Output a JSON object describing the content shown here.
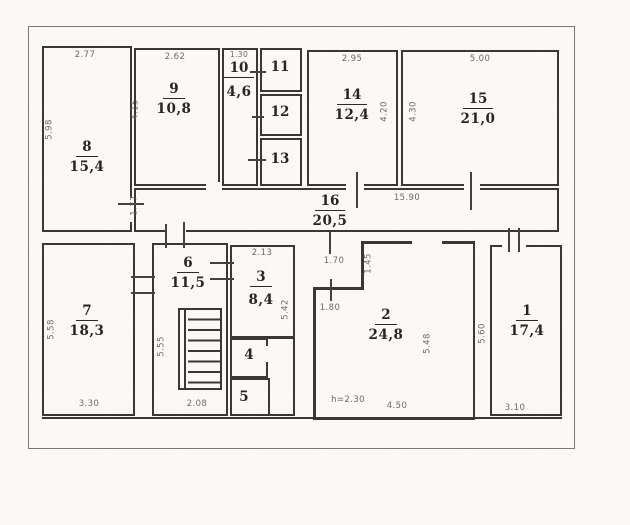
{
  "document": {
    "type": "floor-plan-scan"
  },
  "rooms": [
    {
      "num": "1",
      "area": "17,4"
    },
    {
      "num": "2",
      "area": "24,8"
    },
    {
      "num": "3",
      "area": "8,4"
    },
    {
      "num": "4",
      "area": ""
    },
    {
      "num": "5",
      "area": ""
    },
    {
      "num": "6",
      "area": "11,5"
    },
    {
      "num": "7",
      "area": "18,3"
    },
    {
      "num": "8",
      "area": "15,4"
    },
    {
      "num": "9",
      "area": "10,8"
    },
    {
      "num": "10",
      "area": "4,6"
    },
    {
      "num": "11",
      "area": ""
    },
    {
      "num": "12",
      "area": ""
    },
    {
      "num": "13",
      "area": ""
    },
    {
      "num": "14",
      "area": "12,4"
    },
    {
      "num": "15",
      "area": "21,0"
    },
    {
      "num": "16",
      "area": "20,5"
    }
  ],
  "dimensions": {
    "room8_top": "2.77",
    "room8_left": "5.98",
    "room9_top": "2.62",
    "room9_left": "4.15",
    "room10_top": "1.30",
    "room14_top": "2.95",
    "room14_right": "4.20",
    "room15_top": "5.00",
    "room15_left": "4.30",
    "corridor_length": "15.90",
    "corridor_left": "1.77",
    "room7_left": "5.58",
    "room7_bottom": "3.30",
    "room6_left": "5.55",
    "room6_bottom": "2.08",
    "room3_top": "2.13",
    "room3_right": "5.42",
    "room2_notch_top": "1.70",
    "room2_notch_side": "1.45",
    "room2_left": "1.80",
    "room2_right": "5.48",
    "room2_bottom": "4.50",
    "room2_height": "h=2.30",
    "room1_left": "5.60",
    "room1_bottom": "3.10"
  },
  "colors": {
    "wall": "#3a3835",
    "paper": "#faf9f6",
    "dim_text": "#5c5a52"
  }
}
